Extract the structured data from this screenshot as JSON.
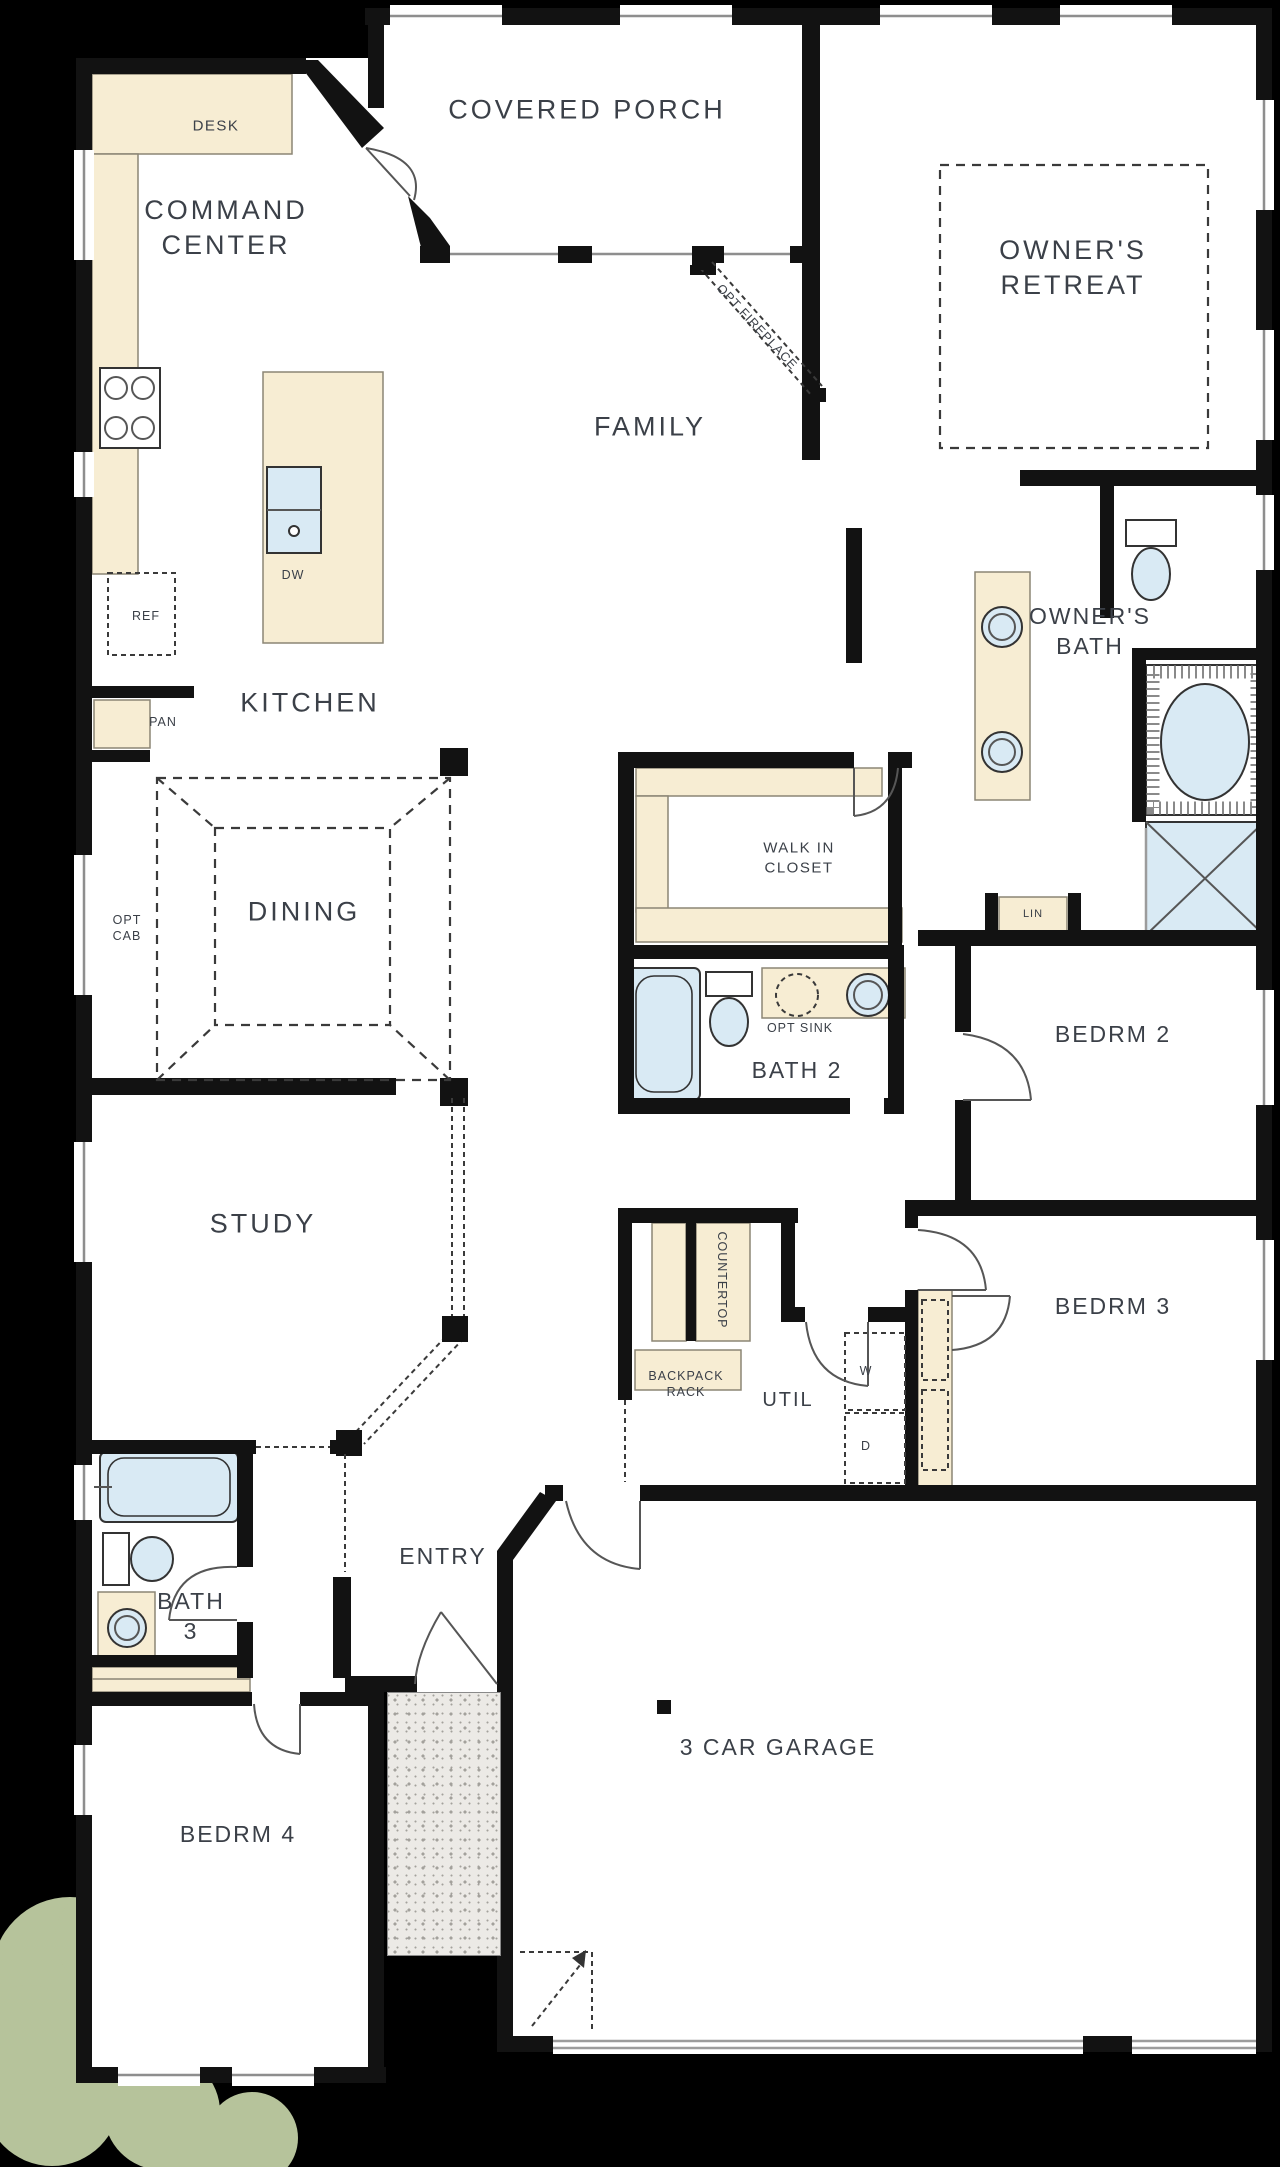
{
  "colors": {
    "wall": "#121212",
    "paper": "#ffffff",
    "ink": "#3b4048",
    "cream": "#f7edd3",
    "creamline": "#8b8575",
    "fix": "#d9eaf4",
    "win": "#8e8e8e",
    "dash": "#3a3a3a",
    "concrete": "#eceae6",
    "dot": "#a3a19c",
    "bush": "#b6c39b"
  },
  "rooms": {
    "covered_porch": "COVERED PORCH",
    "command_center": "COMMAND\nCENTER",
    "owners_retreat": "OWNER'S\nRETREAT",
    "family": "FAMILY",
    "kitchen": "KITCHEN",
    "dining": "DINING",
    "owners_bath": "OWNER'S\nBATH",
    "walk_in_closet": "WALK IN\nCLOSET",
    "bath2": "BATH 2",
    "bedrm2": "BEDRM 2",
    "bedrm3": "BEDRM 3",
    "study": "STUDY",
    "util": "UTIL",
    "entry": "ENTRY",
    "bath3": "BATH\n3",
    "bedrm4": "BEDRM 4",
    "garage": "3 CAR GARAGE"
  },
  "features": {
    "desk": "DESK",
    "dw": "DW",
    "ref": "REF",
    "pan": "PAN",
    "opt_cab": "OPT\nCAB",
    "opt_fireplace": "OPT FIREPLACE",
    "opt_sink": "OPT SINK",
    "lin": "LIN",
    "countertop": "COUNTERTOP",
    "backpack_rack": "BACKPACK\nRACK",
    "washer": "W",
    "dryer": "D"
  }
}
